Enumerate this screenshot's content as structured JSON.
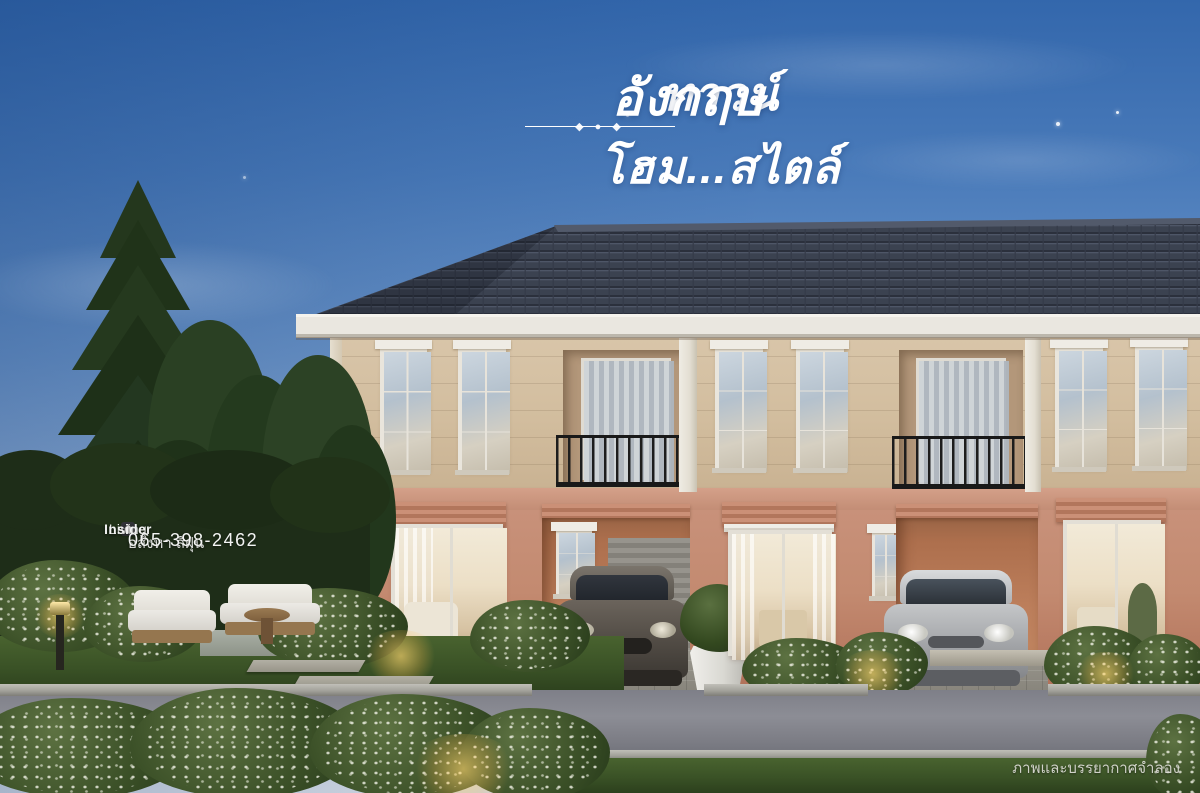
{
  "title": {
    "part1": "ทาวน์โฮม...สไตล์",
    "part2": "อังกฤษ",
    "ornament": "◆ ● ◆"
  },
  "watermark": {
    "brand_light": "Living",
    "brand_bold": "Insider",
    "tagline": "อสังหา สีฝุ่น",
    "phone": "065-398-2462"
  },
  "caption": {
    "text": "ภาพและบรรยากาศจำลอง"
  },
  "palette": {
    "sky_top": "#3367ac",
    "sky_horizon": "#d7dde6",
    "roof_tile": "#3b4250",
    "fascia": "#eae7e0",
    "wall_upper": "#d2bd9e",
    "wall_lower": "#c38a70",
    "carport": "#ad6f4d",
    "railing": "#191919",
    "tree_green": "#26381f",
    "grass": "#3a5226",
    "road": "#8c8d95",
    "title_text": "#ffffff"
  }
}
